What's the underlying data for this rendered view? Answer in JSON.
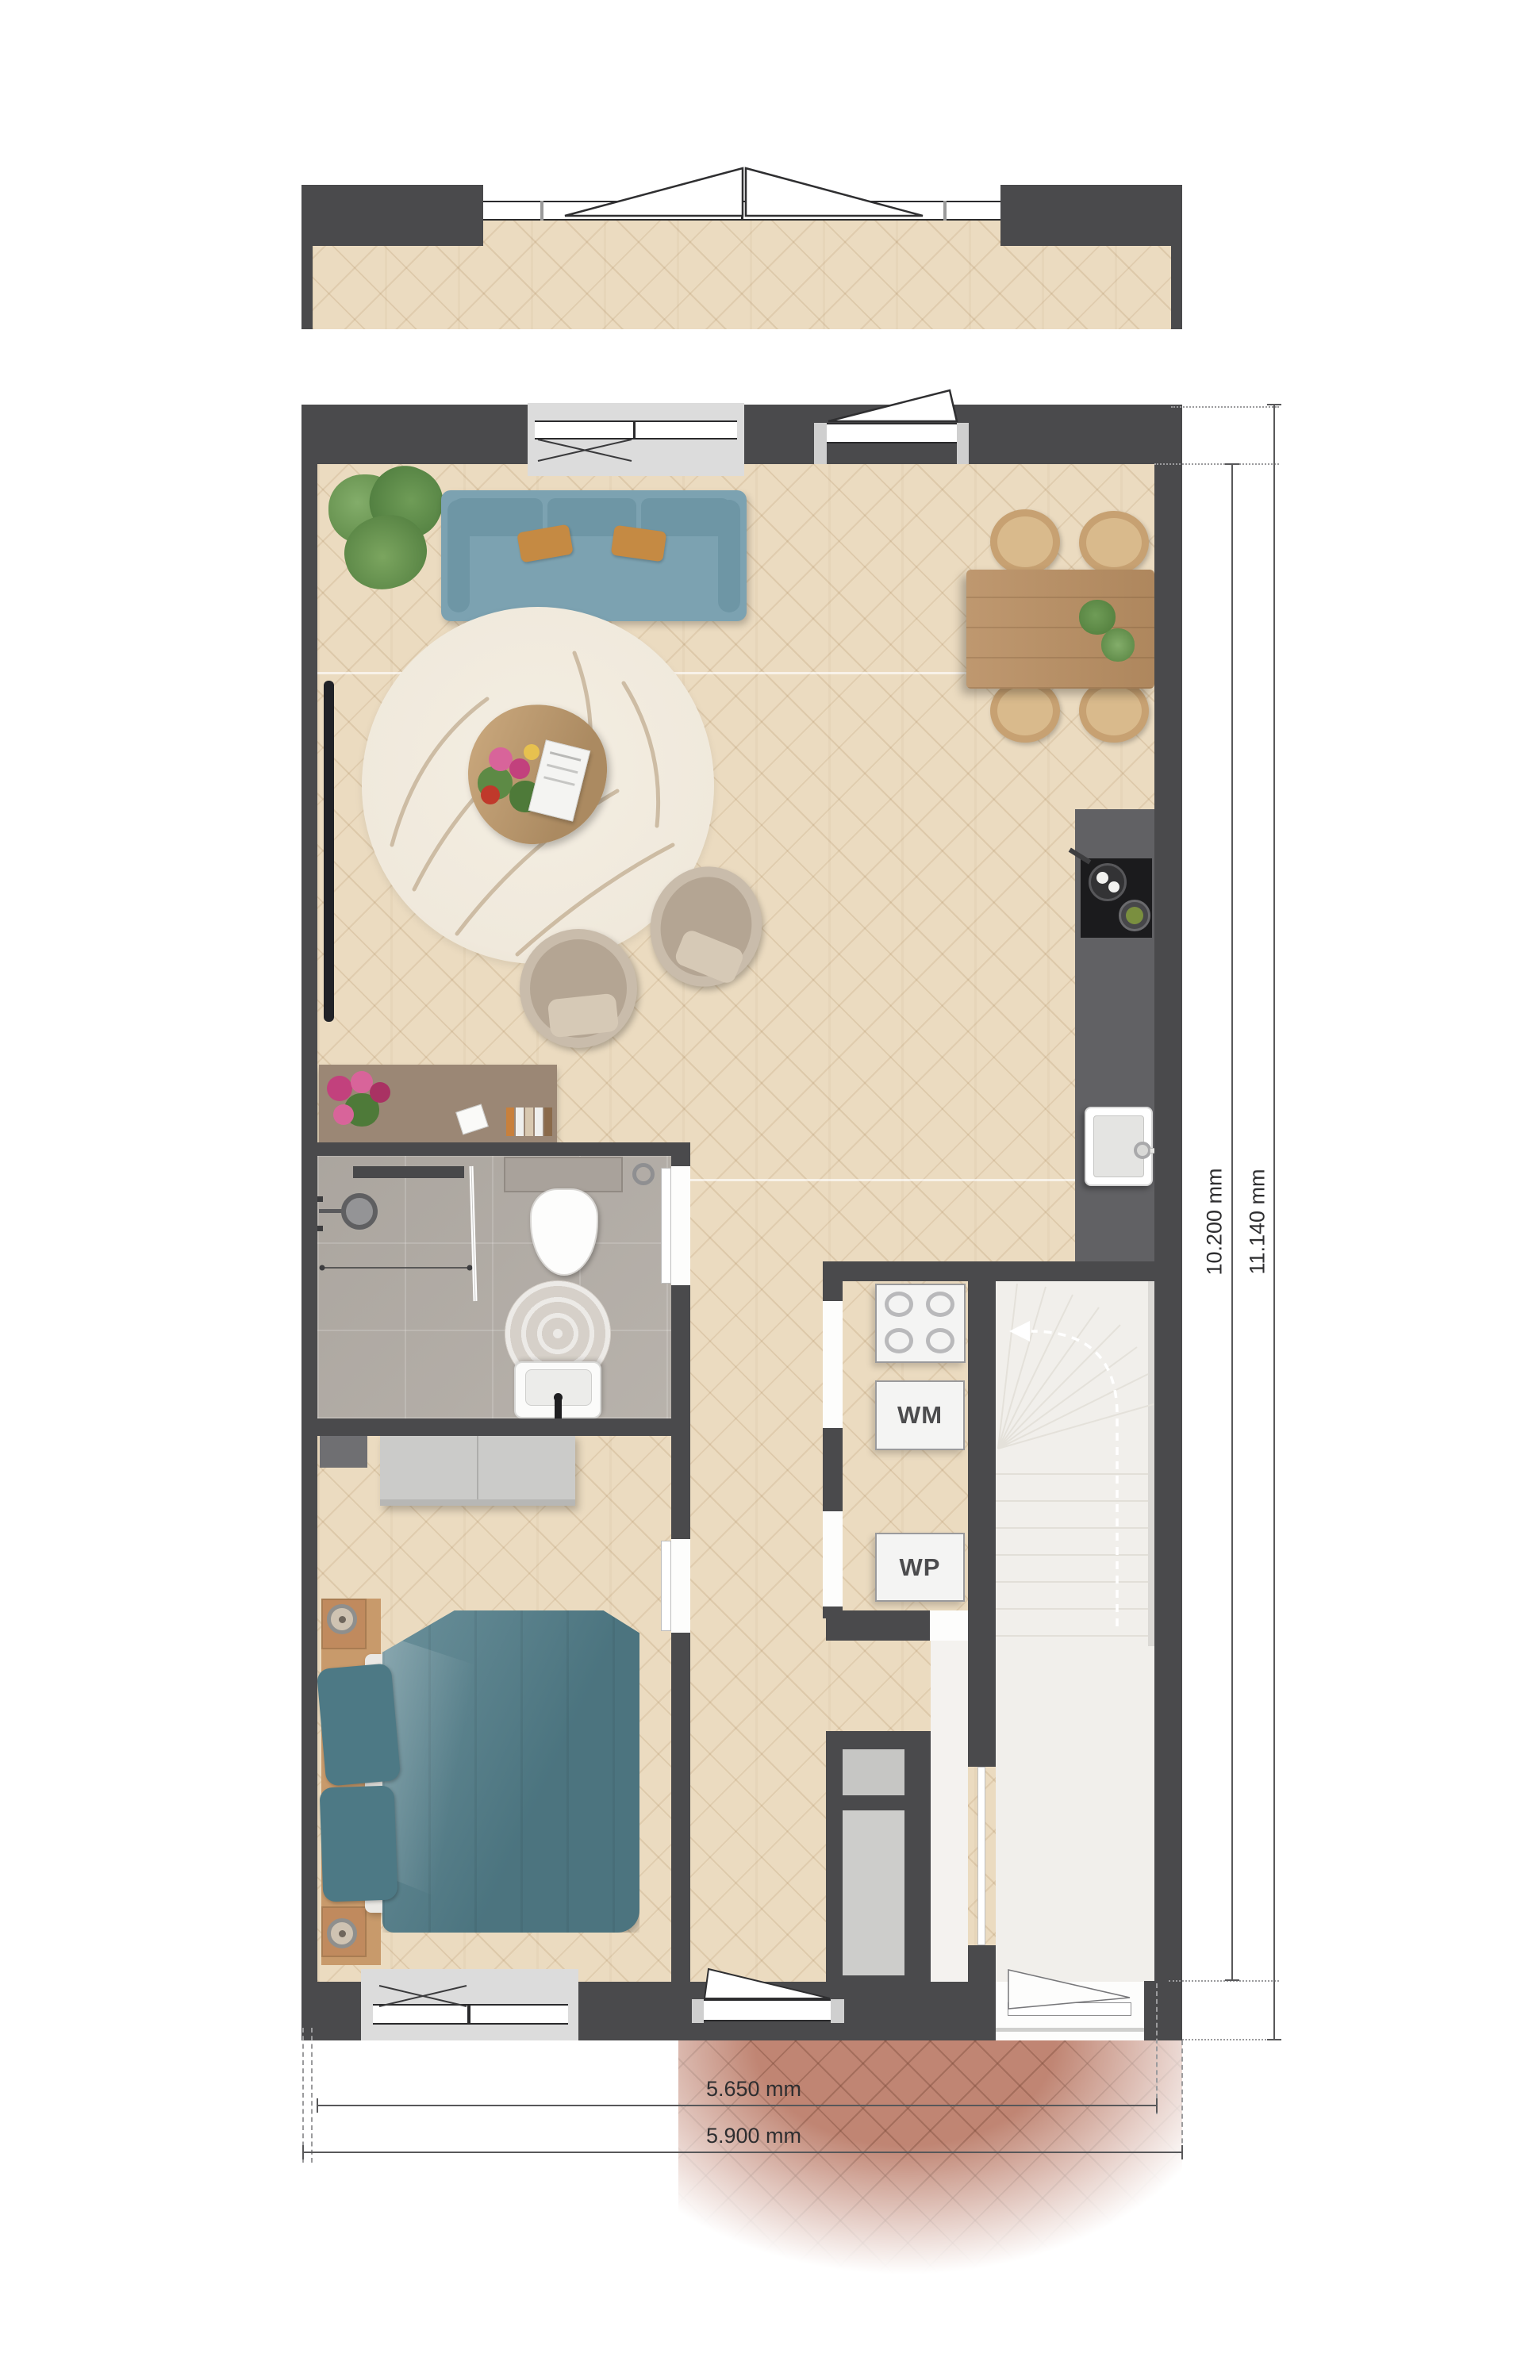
{
  "dims": {
    "v_inner": "10.200 mm",
    "v_outer": "11.140 mm",
    "h_inner": "5.650 mm",
    "h_outer": "5.900 mm"
  },
  "appliances": {
    "washing_machine": "WM",
    "heat_pump": "WP"
  },
  "colors": {
    "wall": "#4a4a4c",
    "wood": "#ebdbc0",
    "tile": "#b4aea7",
    "counter": "#616164",
    "cooktop": "#1b1b1d",
    "sofa": "#7ca2b1",
    "sofadark": "#6e96a5",
    "pillow": "#c58a43",
    "bed": "#527e8a",
    "rug": "#f0e9dc",
    "stairs": "#f1efeb",
    "brick": "#c08573",
    "desk": "#9b8775",
    "tablewood": "#b98f63",
    "chairwood": "#c7a172",
    "dresser": "#cbcbc9",
    "dimline": "#58585a",
    "dimtext": "#2e2e30",
    "apptext": "#4c4c4e"
  }
}
